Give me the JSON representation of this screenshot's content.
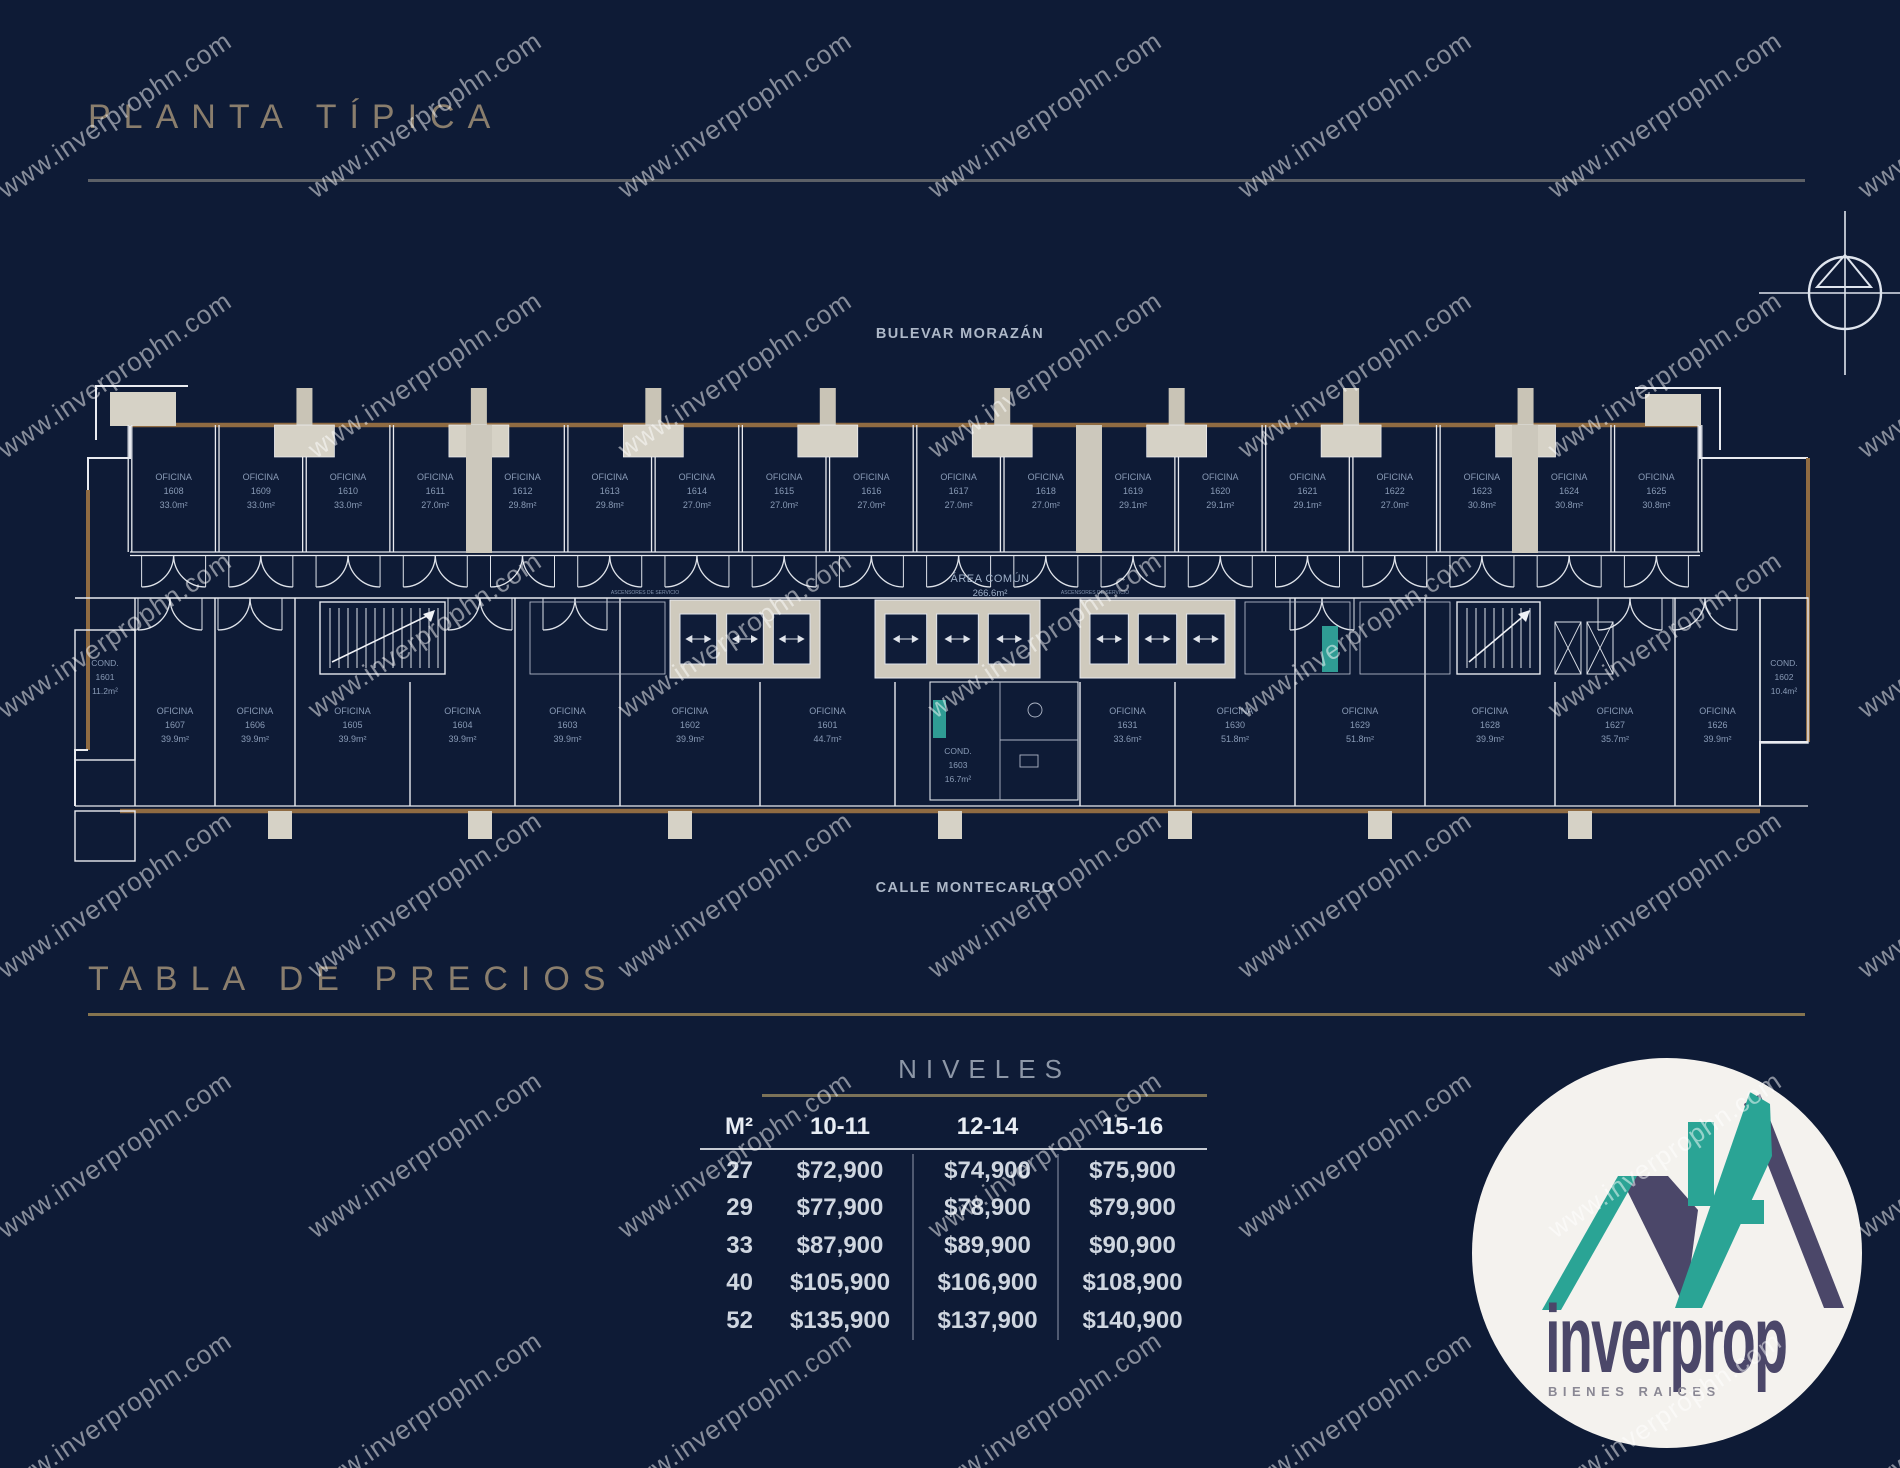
{
  "page": {
    "title": "PLANTA TÍPICA",
    "prices_title": "TABLA DE PRECIOS"
  },
  "streets": {
    "top": "BULEVAR MORAZÁN",
    "bottom": "CALLE MONTECARLO"
  },
  "floor_plan": {
    "office_prefix": "OFICINA",
    "common_area": {
      "line1": "ÁREA COMÚN",
      "line2": "266.6m²"
    },
    "core_label": "ASCENSORES DE SERVICIO",
    "top_row": [
      {
        "num": "1608",
        "area": "33.0m²"
      },
      {
        "num": "1609",
        "area": "33.0m²"
      },
      {
        "num": "1610",
        "area": "33.0m²"
      },
      {
        "num": "1611",
        "area": "27.0m²"
      },
      {
        "num": "1612",
        "area": "29.8m²"
      },
      {
        "num": "1613",
        "area": "29.8m²"
      },
      {
        "num": "1614",
        "area": "27.0m²"
      },
      {
        "num": "1615",
        "area": "27.0m²"
      },
      {
        "num": "1616",
        "area": "27.0m²"
      },
      {
        "num": "1617",
        "area": "27.0m²"
      },
      {
        "num": "1618",
        "area": "27.0m²"
      },
      {
        "num": "1619",
        "area": "29.1m²"
      },
      {
        "num": "1620",
        "area": "29.1m²"
      },
      {
        "num": "1621",
        "area": "29.1m²"
      },
      {
        "num": "1622",
        "area": "27.0m²"
      },
      {
        "num": "1623",
        "area": "30.8m²"
      },
      {
        "num": "1624",
        "area": "30.8m²"
      },
      {
        "num": "1625",
        "area": "30.8m²"
      }
    ],
    "bottom_row": [
      {
        "prefix": "COND.",
        "num": "1601",
        "area": "11.2m²",
        "cap": true
      },
      {
        "num": "1607",
        "area": "39.9m²"
      },
      {
        "num": "1606",
        "area": "39.9m²"
      },
      {
        "num": "1605",
        "area": "39.9m²"
      },
      {
        "num": "1604",
        "area": "39.9m²"
      },
      {
        "num": "1603",
        "area": "39.9m²"
      },
      {
        "num": "1602",
        "area": "39.9m²"
      },
      {
        "num": "1601",
        "area": "44.7m²"
      },
      {
        "prefix": "COND.",
        "num": "1603",
        "area": "16.7m²",
        "core": true
      },
      {
        "num": "1631",
        "area": "33.6m²"
      },
      {
        "num": "1630",
        "area": "51.8m²"
      },
      {
        "num": "1629",
        "area": "51.8m²"
      },
      {
        "num": "1628",
        "area": "39.9m²"
      },
      {
        "num": "1627",
        "area": "35.7m²"
      },
      {
        "num": "1626",
        "area": "39.9m²"
      },
      {
        "prefix": "COND.",
        "num": "1602",
        "area": "10.4m²",
        "cap": true
      }
    ]
  },
  "price_table": {
    "group_header": "NIVELES",
    "columns": [
      "M²",
      "10-11",
      "12-14",
      "15-16"
    ],
    "rows": [
      {
        "m2": "27",
        "values": [
          "$72,900",
          "$74,900",
          "$75,900"
        ]
      },
      {
        "m2": "29",
        "values": [
          "$77,900",
          "$78,900",
          "$79,900"
        ]
      },
      {
        "m2": "33",
        "values": [
          "$87,900",
          "$89,900",
          "$90,900"
        ]
      },
      {
        "m2": "40",
        "values": [
          "$105,900",
          "$106,900",
          "$108,900"
        ]
      },
      {
        "m2": "52",
        "values": [
          "$135,900",
          "$137,900",
          "$140,900"
        ]
      }
    ]
  },
  "watermark": {
    "text": "www.inverprophn.com"
  },
  "logo": {
    "brand": "inverprop",
    "tagline": "BIENES RAICES"
  },
  "colors": {
    "background": "#0e1b36",
    "wall_white": "#e9ebf0",
    "wall_dim": "#aeb6c6",
    "wall_brown": "#8f6b42",
    "block_gray": "#d6d2c6",
    "block_gray2": "#c9c4b6",
    "shaft_gray": "#ccc8bc",
    "label_blue": "#93a5c0",
    "teal": "#35b3a5",
    "logo_teal": "#2aa495",
    "logo_purple": "#4b4769"
  }
}
